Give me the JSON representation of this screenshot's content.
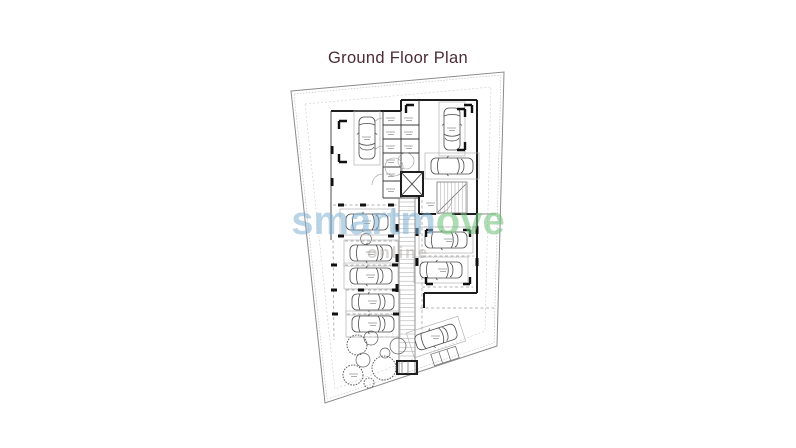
{
  "title": {
    "text": "Ground Floor Plan"
  },
  "watermark": {
    "part1": "smartm",
    "part2": "ove",
    "subtext": "online"
  },
  "colors": {
    "title": "#4d2b38",
    "wm-blue": "rgba(125,177,210,0.55)",
    "wm-green": "rgba(118,196,128,0.60)",
    "wm-sub": "rgba(178,172,166,0.50)",
    "paper": "#ffffff",
    "boundary": "#8a8a8a",
    "wall": "#1d1d1d",
    "stall": "#b4b4b4",
    "tree": "#5f5f5f"
  },
  "plan": {
    "cars": [
      {
        "x": 367,
        "y": 138,
        "rot": 90
      },
      {
        "x": 452,
        "y": 129,
        "rot": 90
      },
      {
        "x": 367,
        "y": 222,
        "rot": 0
      },
      {
        "x": 452,
        "y": 166,
        "rot": 0
      },
      {
        "x": 371,
        "y": 253,
        "rot": 0
      },
      {
        "x": 371,
        "y": 276,
        "rot": 0
      },
      {
        "x": 373,
        "y": 302,
        "rot": 0
      },
      {
        "x": 373,
        "y": 324,
        "rot": 0
      },
      {
        "x": 446,
        "y": 240,
        "rot": 0
      },
      {
        "x": 441,
        "y": 270,
        "rot": 0
      },
      {
        "x": 436,
        "y": 337,
        "rot": -18
      }
    ],
    "trees": [
      {
        "x": 357,
        "y": 345,
        "r": 10,
        "style": "spiky"
      },
      {
        "x": 371,
        "y": 338,
        "r": 7,
        "style": "plain"
      },
      {
        "x": 398,
        "y": 346,
        "r": 8,
        "style": "plain"
      },
      {
        "x": 385,
        "y": 353,
        "r": 5,
        "style": "plain"
      },
      {
        "x": 363,
        "y": 360,
        "r": 7,
        "style": "plain"
      },
      {
        "x": 384,
        "y": 368,
        "r": 12,
        "style": "spiky"
      },
      {
        "x": 353,
        "y": 375,
        "r": 10,
        "style": "spiky"
      },
      {
        "x": 369,
        "y": 383,
        "r": 5,
        "style": "spiky"
      }
    ],
    "dividers": [
      {
        "x1": 333,
        "y1": 205,
        "x2": 398,
        "y2": 205
      },
      {
        "x1": 345,
        "y1": 241,
        "x2": 400,
        "y2": 241
      },
      {
        "x1": 345,
        "y1": 265,
        "x2": 400,
        "y2": 265
      },
      {
        "x1": 346,
        "y1": 290,
        "x2": 400,
        "y2": 290
      },
      {
        "x1": 347,
        "y1": 314,
        "x2": 401,
        "y2": 314
      },
      {
        "x1": 347,
        "y1": 337,
        "x2": 401,
        "y2": 337
      },
      {
        "x1": 333,
        "y1": 240,
        "x2": 334,
        "y2": 340
      },
      {
        "x1": 422,
        "y1": 200,
        "x2": 422,
        "y2": 344
      },
      {
        "x1": 424,
        "y1": 227,
        "x2": 475,
        "y2": 227
      },
      {
        "x1": 423,
        "y1": 256,
        "x2": 474,
        "y2": 256
      },
      {
        "x1": 422,
        "y1": 287,
        "x2": 473,
        "y2": 287
      },
      {
        "x1": 420,
        "y1": 308,
        "x2": 494,
        "y2": 308
      }
    ],
    "piers": [
      {
        "x": 341,
        "y": 205
      },
      {
        "x": 363,
        "y": 205
      },
      {
        "x": 391,
        "y": 205
      },
      {
        "x": 341,
        "y": 236
      },
      {
        "x": 391,
        "y": 236
      },
      {
        "x": 334,
        "y": 265
      },
      {
        "x": 395,
        "y": 265
      },
      {
        "x": 334,
        "y": 290
      },
      {
        "x": 361,
        "y": 290
      },
      {
        "x": 395,
        "y": 290
      },
      {
        "x": 335,
        "y": 314
      },
      {
        "x": 396,
        "y": 314
      },
      {
        "x": 332,
        "y": 150,
        "v": 1
      },
      {
        "x": 332,
        "y": 182,
        "v": 1
      },
      {
        "x": 397,
        "y": 228,
        "v": 1
      },
      {
        "x": 397,
        "y": 258,
        "v": 1
      },
      {
        "x": 397,
        "y": 288,
        "v": 1
      },
      {
        "x": 417,
        "y": 232,
        "v": 1
      },
      {
        "x": 417,
        "y": 262,
        "v": 1
      },
      {
        "x": 477,
        "y": 230,
        "v": 1
      },
      {
        "x": 477,
        "y": 262,
        "v": 1
      }
    ],
    "brackets": [
      {
        "x": 339,
        "y": 121,
        "h": 8,
        "v": 8
      },
      {
        "x": 339,
        "y": 162,
        "h": 8,
        "v": -8
      },
      {
        "x": 465,
        "y": 109,
        "h": -8,
        "v": 8
      },
      {
        "x": 465,
        "y": 150,
        "h": -8,
        "v": -8
      },
      {
        "x": 406,
        "y": 105,
        "h": 8,
        "v": 8
      },
      {
        "x": 472,
        "y": 105,
        "h": -8,
        "v": 8
      },
      {
        "x": 426,
        "y": 230,
        "h": 7,
        "v": 7
      },
      {
        "x": 470,
        "y": 230,
        "h": -7,
        "v": 7
      },
      {
        "x": 426,
        "y": 284,
        "h": 7,
        "v": -7
      },
      {
        "x": 470,
        "y": 284,
        "h": -7,
        "v": -7
      }
    ],
    "label_marks": [
      {
        "x": 391,
        "y": 118
      },
      {
        "x": 391,
        "y": 132
      },
      {
        "x": 391,
        "y": 146
      },
      {
        "x": 391,
        "y": 160
      },
      {
        "x": 391,
        "y": 174
      },
      {
        "x": 391,
        "y": 189
      },
      {
        "x": 409,
        "y": 118
      },
      {
        "x": 409,
        "y": 132
      },
      {
        "x": 409,
        "y": 146
      },
      {
        "x": 431,
        "y": 203
      },
      {
        "x": 367,
        "y": 221
      },
      {
        "x": 371,
        "y": 252
      },
      {
        "x": 371,
        "y": 275
      },
      {
        "x": 373,
        "y": 301
      },
      {
        "x": 373,
        "y": 323
      },
      {
        "x": 449,
        "y": 239
      },
      {
        "x": 443,
        "y": 269
      },
      {
        "x": 367,
        "y": 137
      },
      {
        "x": 452,
        "y": 128
      },
      {
        "x": 436,
        "y": 336
      },
      {
        "x": 354,
        "y": 374
      }
    ],
    "ramp": {
      "x": 399,
      "width": 16,
      "y1": 202,
      "y2": 358,
      "step": 4.4
    },
    "stairs": {
      "x": 437,
      "y": 182,
      "width": 30,
      "height": 31,
      "step": 3.6
    }
  }
}
